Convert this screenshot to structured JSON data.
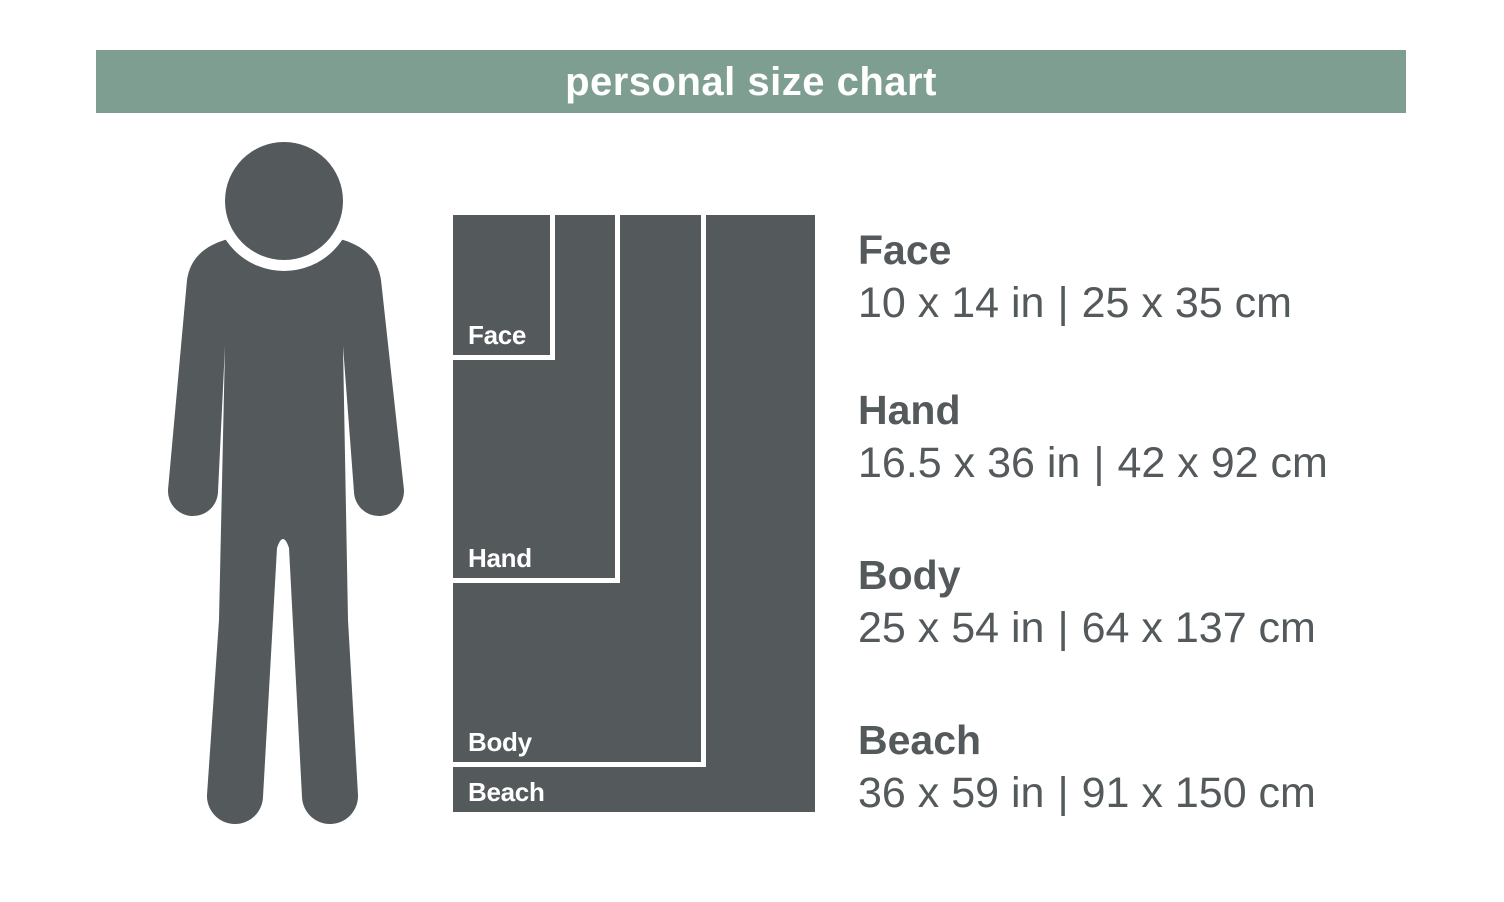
{
  "title": "personal size chart",
  "separator": "|",
  "colors": {
    "banner_green": "#7d9e91",
    "dark_gray": "#54595c",
    "label_white": "#ffffff"
  },
  "person_icon": "standing-person-silhouette",
  "sizes": [
    {
      "name": "Face",
      "inches": "10 x 14 in",
      "cm": "25 x 35 cm"
    },
    {
      "name": "Hand",
      "inches": "16.5 x 36 in",
      "cm": "42 x 92 cm"
    },
    {
      "name": "Body",
      "inches": "25 x 54 in",
      "cm": "64 x 137 cm"
    },
    {
      "name": "Beach",
      "inches": "36 x 59 in",
      "cm": "91 x 150 cm"
    }
  ],
  "chart_data": {
    "type": "table",
    "title": "personal size chart",
    "columns": [
      "Towel",
      "Size (in)",
      "Size (cm)"
    ],
    "rows": [
      [
        "Face",
        "10 x 14 in",
        "25 x 35 cm"
      ],
      [
        "Hand",
        "16.5 x 36 in",
        "42 x 92 cm"
      ],
      [
        "Body",
        "25 x 54 in",
        "64 x 137 cm"
      ],
      [
        "Beach",
        "36 x 59 in",
        "91 x 150 cm"
      ]
    ],
    "note": "nested rectangles drawn proportional to towel dimensions, with a human figure for scale"
  }
}
